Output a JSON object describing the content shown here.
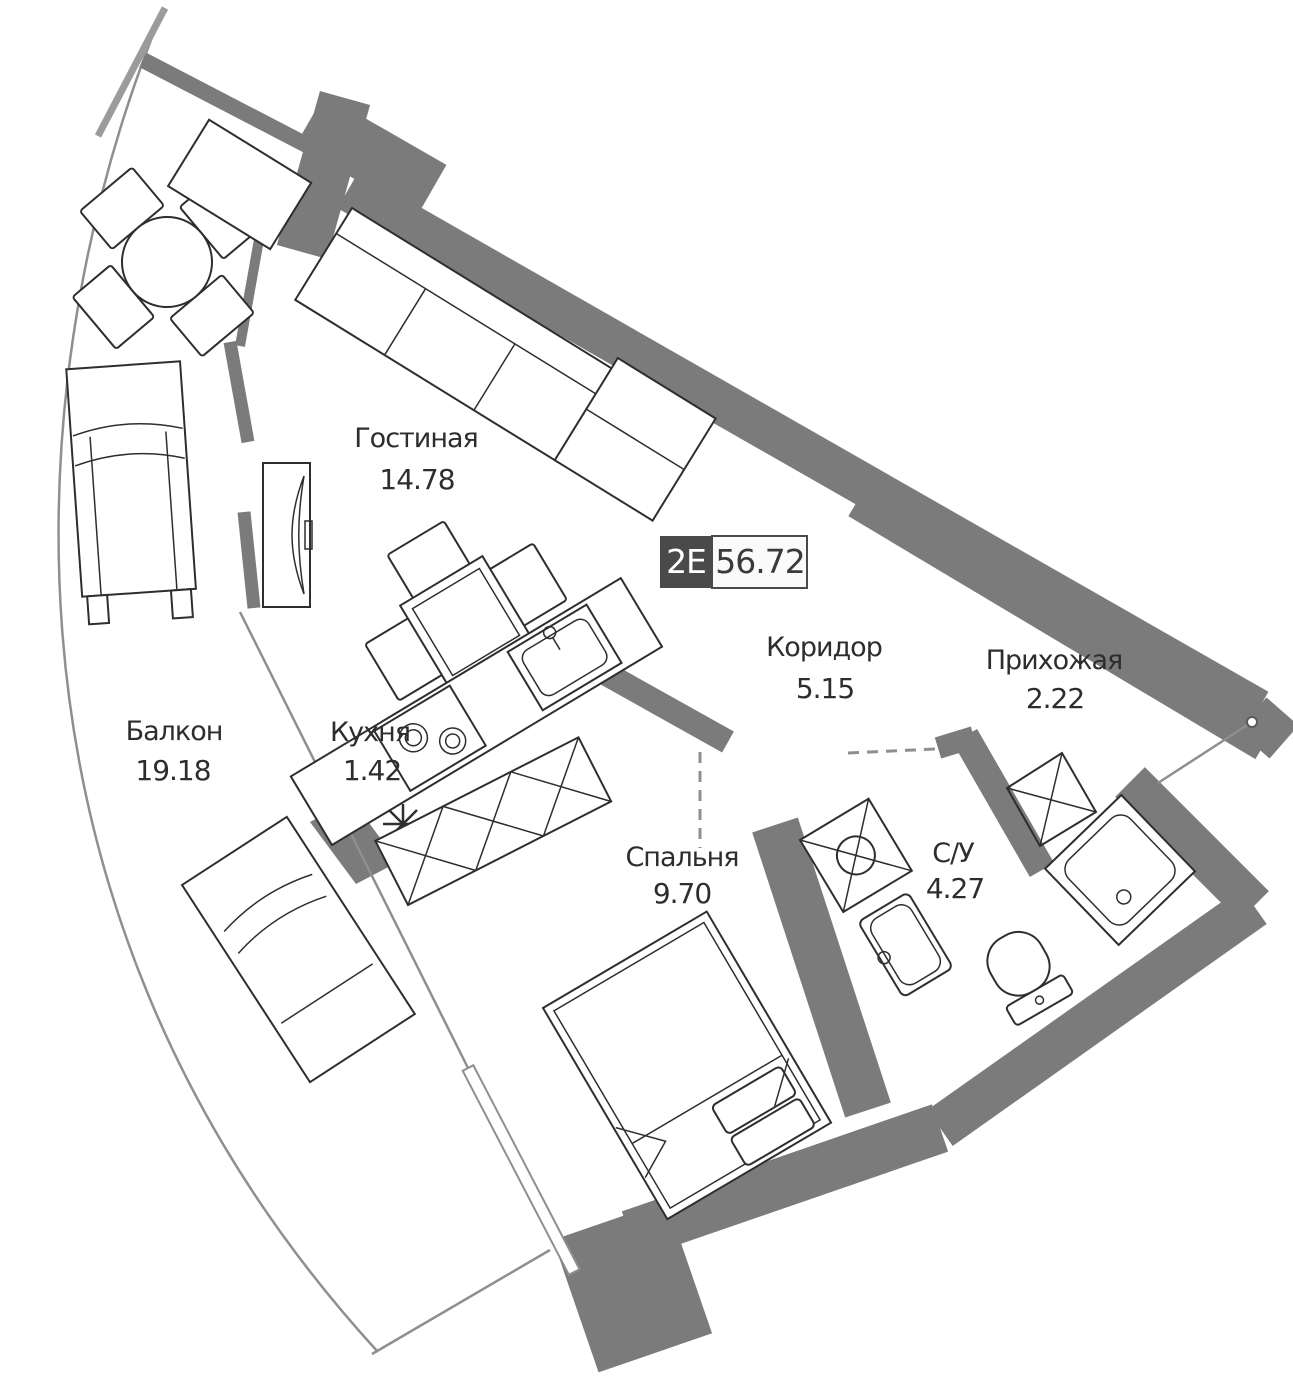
{
  "unit": {
    "type_label": "2Е",
    "total_area": "56.72"
  },
  "rooms": {
    "living": {
      "name": "Гостиная",
      "area": "14.78"
    },
    "corridor": {
      "name": "Коридор",
      "area": "5.15"
    },
    "hallway": {
      "name": "Прихожая",
      "area": "2.22"
    },
    "balcony": {
      "name": "Балкон",
      "area": "19.18"
    },
    "kitchen": {
      "name": "Кухня",
      "area": "1.42"
    },
    "bedroom": {
      "name": "Спальня",
      "area": "9.70"
    },
    "bathroom": {
      "name": "С/У",
      "area": "4.27"
    }
  },
  "colors": {
    "wall": "#7b7b7b",
    "furniture_line": "#2e2e2e",
    "thin_line": "#8f8f8f",
    "text": "#2d2d2d",
    "badge_background": "#4a4a4a",
    "badge_text": "#ffffff",
    "badge_value_text": "#3a3a3a",
    "background": "#ffffff"
  }
}
